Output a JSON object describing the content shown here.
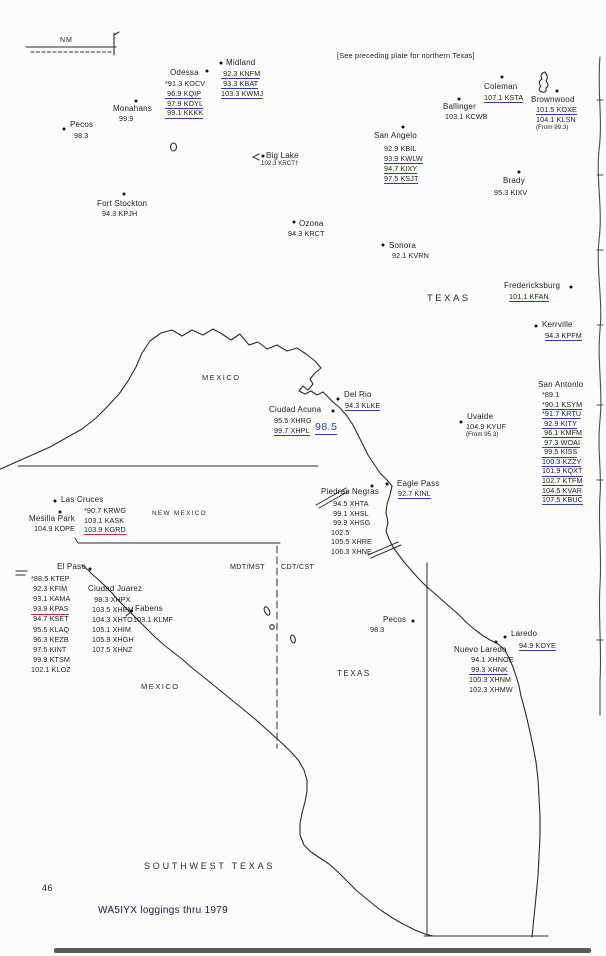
{
  "page": {
    "plate_title": "SOUTHWEST TEXAS",
    "number": "46",
    "caption": "WA5IYX loggings thru 1979",
    "note": "[See preceding plate for northern Texas]"
  },
  "timezone": {
    "west": "MDT/MST",
    "east": "CDT/CST"
  },
  "colors": {
    "ink": "#1d1d1d",
    "pen_blue": "#2b3fb5",
    "pen_red": "#c23127"
  },
  "labels": [
    {
      "id": "nm",
      "t": "NM",
      "x": 60,
      "y": 37,
      "fs": 7,
      "ls": 1
    },
    {
      "id": "texas-upper",
      "t": "TEXAS",
      "x": 427,
      "y": 294,
      "fs": 9.5,
      "ls": 2.5
    },
    {
      "id": "mexico-upper",
      "t": "MEXICO",
      "x": 202,
      "y": 374,
      "fs": 7.5,
      "ls": 1.5
    },
    {
      "id": "new-mexico",
      "t": "NEW MEXICO",
      "x": 152,
      "y": 511,
      "fs": 6.4,
      "ls": 1.3
    },
    {
      "id": "texas-lower",
      "t": "TEXAS",
      "x": 337,
      "y": 670,
      "fs": 8,
      "ls": 1.5
    },
    {
      "id": "mexico-lower",
      "t": "MEXICO",
      "x": 141,
      "y": 683,
      "fs": 7.5,
      "ls": 1.5
    }
  ],
  "annotations": [
    {
      "id": "handwritten-98-5",
      "t": "98.5",
      "x": 315,
      "y": 421
    }
  ],
  "cities": [
    {
      "id": "pecos",
      "name": "Pecos",
      "nx": 70,
      "ny": 121,
      "dot": {
        "x": 64,
        "y": 129
      },
      "list": {
        "x": 74,
        "y": 132,
        "lh": 10
      },
      "stations": [
        {
          "t": "98.3"
        }
      ]
    },
    {
      "id": "monahans",
      "name": "Monahans",
      "nx": 113,
      "ny": 105,
      "dot": {
        "x": 136,
        "y": 101
      },
      "list": {
        "x": 119,
        "y": 115,
        "lh": 10
      },
      "stations": [
        {
          "t": "99.9"
        }
      ]
    },
    {
      "id": "odessa",
      "name": "Odessa",
      "nx": 170,
      "ny": 69,
      "dot": {
        "x": 207,
        "y": 71
      },
      "list": {
        "x": 165,
        "y": 80,
        "lh": 9.8
      },
      "stations": [
        {
          "t": "*91.3 KOCV"
        },
        {
          "t": " 96.9 KQIP",
          "u": "b"
        },
        {
          "t": " 97.9 KOYL",
          "u": "b"
        },
        {
          "t": " 99.1 KKKK",
          "u": "b"
        }
      ]
    },
    {
      "id": "midland",
      "name": "Midland",
      "nx": 226,
      "ny": 59,
      "dot": {
        "x": 221,
        "y": 63
      },
      "list": {
        "x": 221,
        "y": 70,
        "lh": 9.8
      },
      "stations": [
        {
          "t": " 92.3 KNFM",
          "u": "b"
        },
        {
          "t": " 93.3 KBAT",
          "u": "b"
        },
        {
          "t": "103.3 KWMJ",
          "u": "b"
        }
      ]
    },
    {
      "id": "coleman",
      "name": "Coleman",
      "nx": 484,
      "ny": 83,
      "dot": {
        "x": 502,
        "y": 77
      },
      "list": {
        "x": 484,
        "y": 94,
        "lh": 10
      },
      "stations": [
        {
          "t": "107.1 KSTA",
          "u": "b"
        }
      ]
    },
    {
      "id": "ballinger",
      "name": "Ballinger",
      "nx": 443,
      "ny": 103,
      "dot": {
        "x": 459,
        "y": 99
      },
      "list": {
        "x": 445,
        "y": 113,
        "lh": 10
      },
      "stations": [
        {
          "t": "103.1 KCWB"
        }
      ]
    },
    {
      "id": "brownwood",
      "name": "Brownwood",
      "nx": 531,
      "ny": 96,
      "dot": {
        "x": 557,
        "y": 91
      },
      "list": {
        "x": 536,
        "y": 106,
        "lh": 9.6
      },
      "stations": [
        {
          "t": "101.5 KOXE",
          "u": "b"
        },
        {
          "t": "104.1 KLSN"
        },
        {
          "t": "(From 99.3)",
          "s": 1
        }
      ]
    },
    {
      "id": "san-angelo",
      "name": "San Angelo",
      "nx": 374,
      "ny": 132,
      "dot": {
        "x": 403,
        "y": 127
      },
      "list": {
        "x": 384,
        "y": 145,
        "lh": 10
      },
      "stations": [
        {
          "t": "92.9 KBIL"
        },
        {
          "t": "93.9 KWLW",
          "u": "b"
        },
        {
          "t": "94.7 KIXY",
          "u": "b"
        },
        {
          "t": "97.5 KSJT",
          "u": "b"
        }
      ]
    },
    {
      "id": "big-lake",
      "name": "Big Lake",
      "nx": 266,
      "ny": 152,
      "dot": {
        "x": 263,
        "y": 156
      },
      "list": {
        "x": 261,
        "y": 161,
        "lh": 9
      },
      "stations": [
        {
          "t": "102.3 KRCT†",
          "s": 1
        }
      ]
    },
    {
      "id": "fort-stockton",
      "name": "Fort Stockton",
      "nx": 97,
      "ny": 200,
      "dot": {
        "x": 124,
        "y": 194
      },
      "list": {
        "x": 102,
        "y": 210,
        "lh": 10
      },
      "stations": [
        {
          "t": "94.3 KPJH"
        }
      ]
    },
    {
      "id": "brady",
      "name": "Brady",
      "nx": 503,
      "ny": 177,
      "dot": {
        "x": 519,
        "y": 172
      },
      "list": {
        "x": 494,
        "y": 189,
        "lh": 10
      },
      "stations": [
        {
          "t": "95.3 KIXV"
        }
      ]
    },
    {
      "id": "ozona",
      "name": "Ozona",
      "nx": 299,
      "ny": 220,
      "dot": {
        "x": 294,
        "y": 222
      },
      "list": {
        "x": 288,
        "y": 230,
        "lh": 10
      },
      "stations": [
        {
          "t": "94.3 KRCT"
        }
      ]
    },
    {
      "id": "sonora",
      "name": "Sonora",
      "nx": 389,
      "ny": 242,
      "dot": {
        "x": 383,
        "y": 245
      },
      "list": {
        "x": 392,
        "y": 252,
        "lh": 10
      },
      "stations": [
        {
          "t": "92.1 KVRN"
        }
      ]
    },
    {
      "id": "fredericksburg",
      "name": "Fredericksburg",
      "nx": 504,
      "ny": 282,
      "dot": {
        "x": 571,
        "y": 287
      },
      "list": {
        "x": 509,
        "y": 293,
        "lh": 10
      },
      "stations": [
        {
          "t": "101.1 KFAN",
          "u": "b"
        }
      ]
    },
    {
      "id": "kerrville",
      "name": "Kerrville",
      "nx": 542,
      "ny": 321,
      "dot": {
        "x": 536,
        "y": 326
      },
      "list": {
        "x": 545,
        "y": 332,
        "lh": 10
      },
      "stations": [
        {
          "t": "94.3 KPFM",
          "u": "b"
        }
      ]
    },
    {
      "id": "san-antonio",
      "name": "San Antonio",
      "nx": 538,
      "ny": 381,
      "dot": null,
      "list": {
        "x": 542,
        "y": 391,
        "lh": 9.55
      },
      "stations": [
        {
          "t": "*89.1"
        },
        {
          "t": "*90.1 KSYM",
          "u": "b"
        },
        {
          "t": "*91.7 KRTU",
          "u": "b"
        },
        {
          "t": " 92.9 KITY",
          "u": "b"
        },
        {
          "t": " 96.1 KMFM",
          "u": "b"
        },
        {
          "t": " 97.3 WOAI",
          "u": "b"
        },
        {
          "t": " 99.5 KISS",
          "u": "b"
        },
        {
          "t": "100.3 KZZY",
          "u": "b"
        },
        {
          "t": "101.9 KQXT",
          "u": "b"
        },
        {
          "t": "102.7 KTFM",
          "u": "b"
        },
        {
          "t": "104.5 KVAR",
          "u": "b"
        },
        {
          "t": "107.5 KBUC",
          "u": "b"
        }
      ]
    },
    {
      "id": "del-rio",
      "name": "Del Rio",
      "nx": 344,
      "ny": 391,
      "dot": {
        "x": 338,
        "y": 399
      },
      "list": {
        "x": 345,
        "y": 402,
        "lh": 10
      },
      "stations": [
        {
          "t": "94.3 KLKE",
          "u": "b"
        }
      ]
    },
    {
      "id": "ciudad-acuna",
      "name": "Ciudad Acuna",
      "nx": 269,
      "ny": 406,
      "dot": {
        "x": 333,
        "y": 411
      },
      "list": {
        "x": 274,
        "y": 417,
        "lh": 9.8
      },
      "stations": [
        {
          "t": "95.5 XHRG"
        },
        {
          "t": "99.7 XHPL",
          "u": "b"
        }
      ]
    },
    {
      "id": "uvalde",
      "name": "Uvalde",
      "nx": 467,
      "ny": 413,
      "dot": {
        "x": 461,
        "y": 422
      },
      "list": {
        "x": 466,
        "y": 423,
        "lh": 9
      },
      "stations": [
        {
          "t": "104.9 KYUF"
        },
        {
          "t": "(From 95.3)",
          "s": 1
        }
      ]
    },
    {
      "id": "eagle-pass",
      "name": "Eagle Pass",
      "nx": 397,
      "ny": 480,
      "dot": {
        "x": 387,
        "y": 484
      },
      "list": {
        "x": 398,
        "y": 490,
        "lh": 10
      },
      "stations": [
        {
          "t": "92.7 KINL",
          "u": "b"
        }
      ]
    },
    {
      "id": "piedras-negras",
      "name": "Piedras Negras",
      "nx": 321,
      "ny": 488,
      "dot": {
        "x": 372,
        "y": 486
      },
      "list": {
        "x": 331,
        "y": 500,
        "lh": 9.6
      },
      "stations": [
        {
          "t": " 94.5 XHTA"
        },
        {
          "t": " 99.1 XHSL"
        },
        {
          "t": " 99.9 XHSG"
        },
        {
          "t": "102.5"
        },
        {
          "t": "105.5 XHRE"
        },
        {
          "t": "106.3 XHNE"
        }
      ]
    },
    {
      "id": "las-cruces",
      "name": "Las Cruces",
      "nx": 61,
      "ny": 496,
      "dot": {
        "x": 55,
        "y": 501
      },
      "list": {
        "x": 84,
        "y": 507,
        "lh": 9.6
      },
      "stations": [
        {
          "t": "*90.7 KRWG"
        },
        {
          "t": "103.1 KASK"
        },
        {
          "t": "103.9 KGRD",
          "u": "r"
        }
      ]
    },
    {
      "id": "mesilla-park",
      "name": "Mesilla Park",
      "nx": 29,
      "ny": 515,
      "dot": {
        "x": 60,
        "y": 512
      },
      "list": {
        "x": 34,
        "y": 525,
        "lh": 10
      },
      "stations": [
        {
          "t": "104.9 KOPE"
        }
      ]
    },
    {
      "id": "el-paso",
      "name": "El Paso",
      "nx": 57,
      "ny": 563,
      "dot": {
        "x": 90,
        "y": 569
      },
      "list": {
        "x": 31,
        "y": 575,
        "lh": 10.1
      },
      "stations": [
        {
          "t": "*88.5 KTEP"
        },
        {
          "t": " 92.3 KFIM"
        },
        {
          "t": " 93.1 KAMA"
        },
        {
          "t": " 93.9 KPAS",
          "u": "r"
        },
        {
          "t": " 94.7 KSET"
        },
        {
          "t": " 95.5 KLAQ"
        },
        {
          "t": " 96.3 KEZB"
        },
        {
          "t": " 97.5 KINT"
        },
        {
          "t": " 99.9 KTSM"
        },
        {
          "t": "102.1 KLOZ"
        }
      ]
    },
    {
      "id": "ciudad-juarez",
      "name": "Ciudad Juarez",
      "nx": 88,
      "ny": 585,
      "dot": null,
      "list": {
        "x": 92,
        "y": 596,
        "lh": 10
      },
      "stations": [
        {
          "t": " 98.3 XHPX"
        },
        {
          "t": "103.5 XHEM"
        },
        {
          "t": "104.3 XHTO"
        },
        {
          "t": "105.1 XHIM"
        },
        {
          "t": "105.9 XHGH"
        },
        {
          "t": "107.5 XHNZ"
        }
      ]
    },
    {
      "id": "fabens",
      "name": "Fabens",
      "nx": 135,
      "ny": 605,
      "dot": {
        "x": 131,
        "y": 611
      },
      "list": {
        "x": 133,
        "y": 616,
        "lh": 10
      },
      "stations": [
        {
          "t": "103.1 KLMF"
        }
      ]
    },
    {
      "id": "pecos-2",
      "name": "Pecos",
      "nx": 383,
      "ny": 616,
      "dot": {
        "x": 413,
        "y": 621
      },
      "list": {
        "x": 370,
        "y": 626,
        "lh": 10
      },
      "stations": [
        {
          "t": "98.3"
        }
      ]
    },
    {
      "id": "laredo",
      "name": "Laredo",
      "nx": 511,
      "ny": 630,
      "dot": {
        "x": 505,
        "y": 637
      },
      "list": {
        "x": 519,
        "y": 642,
        "lh": 10
      },
      "stations": [
        {
          "t": "94.9 KOYE",
          "u": "b"
        }
      ]
    },
    {
      "id": "nuevo-laredo",
      "name": "Nuevo Laredo",
      "nx": 454,
      "ny": 646,
      "dot": {
        "x": 496,
        "y": 642
      },
      "list": {
        "x": 469,
        "y": 656,
        "lh": 9.9
      },
      "stations": [
        {
          "t": " 94.1 XHNOE"
        },
        {
          "t": " 99.3 XHNK",
          "u": "b"
        },
        {
          "t": "100.3 XHNM"
        },
        {
          "t": "102.3 XHMW"
        }
      ]
    }
  ]
}
